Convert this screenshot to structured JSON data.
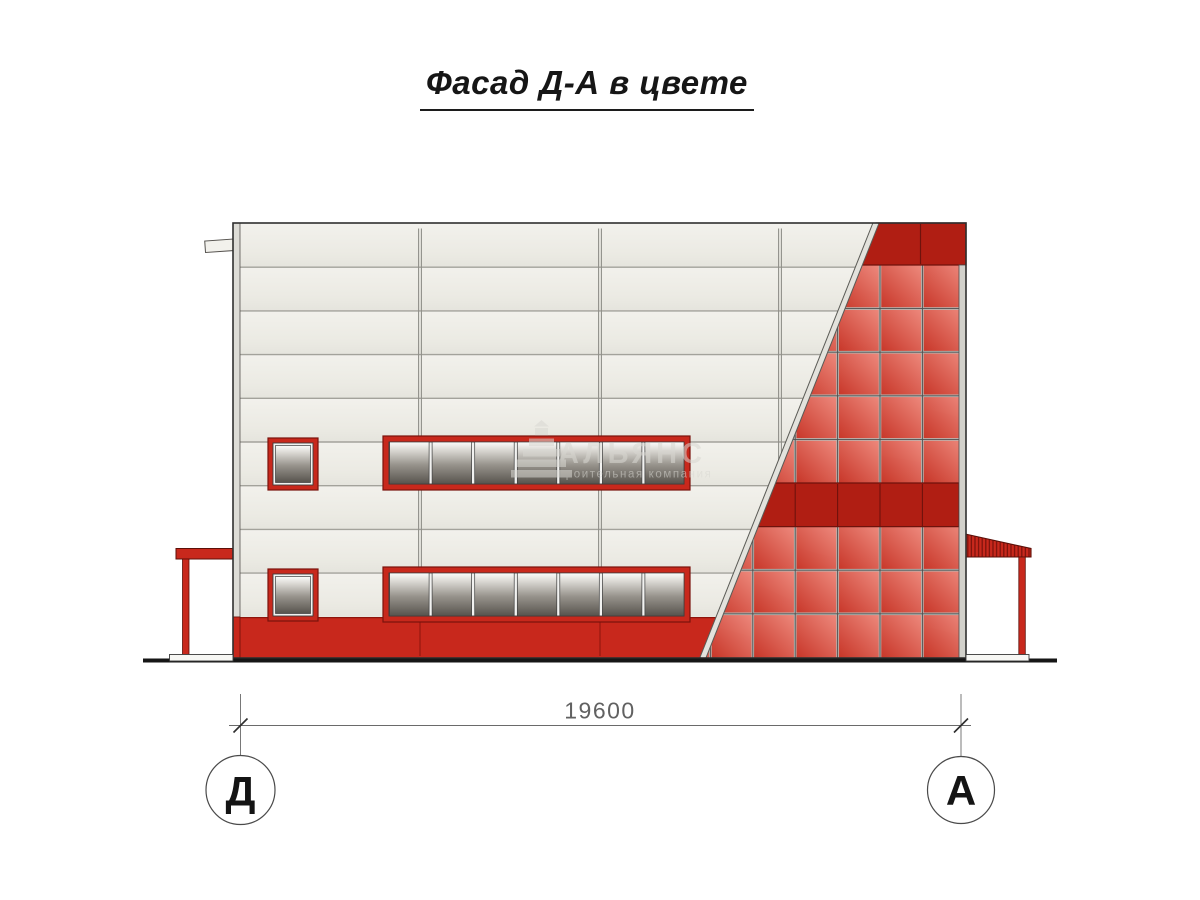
{
  "title": {
    "text": "Фасад Д-А в цвете"
  },
  "drawing": {
    "dimension_label": "19600",
    "axis_left": "Д",
    "axis_right": "А"
  },
  "watermark": {
    "brand": "АЛЬЯНС",
    "tagline": "строительная компания"
  },
  "colors": {
    "accent_red": "#c8281c",
    "dark_red": "#b01e13",
    "glazing_light": "#ee8a7e",
    "glazing_dark": "#c73527",
    "wall_panel": "#ecebe4",
    "glass_dark": "#57534d",
    "outline": "#2f2f2f"
  }
}
